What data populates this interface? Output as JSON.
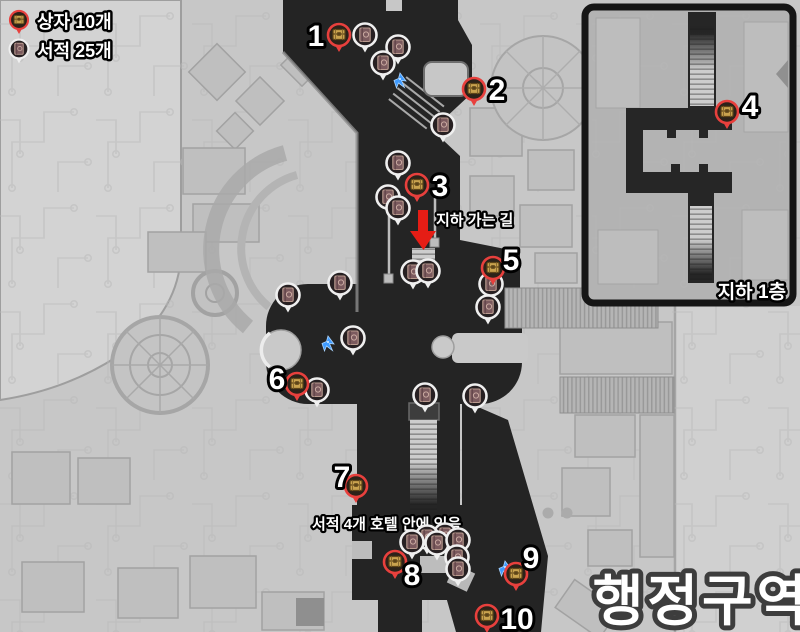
{
  "legend": {
    "chest_label": "상자 10개",
    "book_label": "서적 25개"
  },
  "region_title": "행정구역",
  "inset": {
    "label": "지하 1층"
  },
  "annotations": {
    "underground_path": "지하 가는 길",
    "hotel_books": "서적 4개 호텔 안에 있음"
  },
  "markers": {
    "chests": [
      {
        "n": "1",
        "x": 339,
        "y": 35,
        "lx": 316,
        "ly": 46
      },
      {
        "n": "2",
        "x": 474,
        "y": 89,
        "lx": 497,
        "ly": 100
      },
      {
        "n": "3",
        "x": 417,
        "y": 185,
        "lx": 440,
        "ly": 196
      },
      {
        "n": "4",
        "x": 727,
        "y": 112,
        "lx": 750,
        "ly": 116
      },
      {
        "n": "5",
        "x": 493,
        "y": 268,
        "lx": 511,
        "ly": 270
      },
      {
        "n": "6",
        "x": 297,
        "y": 384,
        "lx": 277,
        "ly": 389
      },
      {
        "n": "7",
        "x": 356,
        "y": 486,
        "lx": 342,
        "ly": 487
      },
      {
        "n": "8",
        "x": 395,
        "y": 562,
        "lx": 412,
        "ly": 585
      },
      {
        "n": "9",
        "x": 516,
        "y": 574,
        "lx": 531,
        "ly": 568
      },
      {
        "n": "10",
        "x": 487,
        "y": 616,
        "lx": 517,
        "ly": 629
      }
    ],
    "books": [
      [
        365,
        35
      ],
      [
        398,
        47
      ],
      [
        383,
        63
      ],
      [
        443,
        125
      ],
      [
        398,
        163
      ],
      [
        388,
        197
      ],
      [
        398,
        208
      ],
      [
        413,
        272
      ],
      [
        428,
        271
      ],
      [
        491,
        284
      ],
      [
        488,
        307
      ],
      [
        288,
        295
      ],
      [
        340,
        283
      ],
      [
        353,
        338
      ],
      [
        317,
        390
      ],
      [
        425,
        395
      ],
      [
        475,
        396
      ],
      [
        445,
        535
      ],
      [
        427,
        537
      ],
      [
        412,
        542
      ],
      [
        437,
        543
      ],
      [
        458,
        540
      ],
      [
        457,
        557
      ],
      [
        458,
        569
      ]
    ],
    "birds": [
      [
        400,
        80
      ],
      [
        328,
        343
      ],
      [
        505,
        568
      ]
    ]
  },
  "colors": {
    "chest_pin_ring": "#e8403d",
    "book_pin_ring": "#efefef",
    "bird_blue": "#3f9bff",
    "arrow_red": "#e51d15",
    "corridor_dark": "#242424",
    "map_light": "#c7c7c7"
  }
}
